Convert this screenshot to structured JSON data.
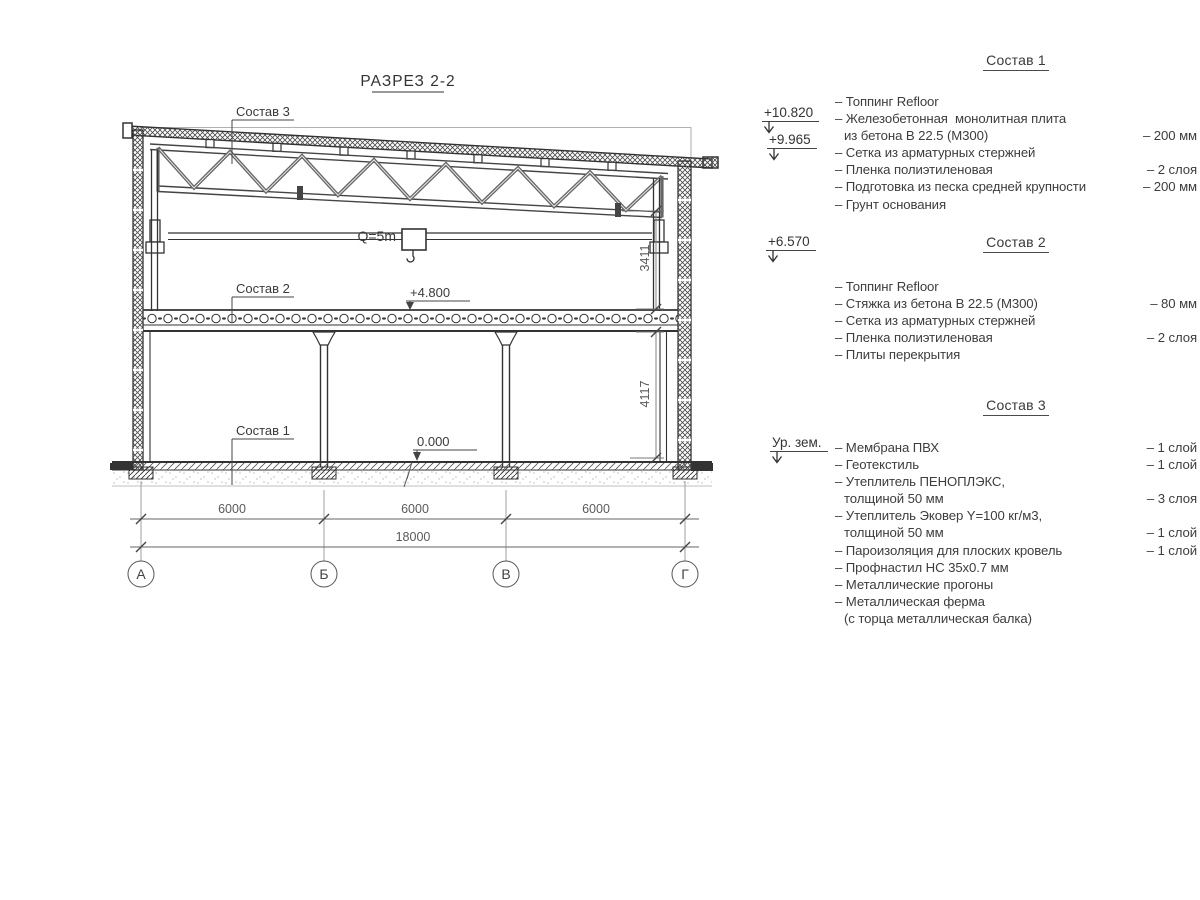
{
  "colors": {
    "background": "#ffffff",
    "line": "#3f3f3f",
    "dim_text": "#5a5a5a",
    "text": "#3a3a3a"
  },
  "drawing": {
    "title": "РАЗРЕЗ 2-2",
    "callouts": {
      "c3": "Состав 3",
      "c2": "Состав 2",
      "c1": "Состав 1"
    },
    "crane_label": "Q=5m",
    "elev_mid": "+4.800",
    "elev_zero": "0.000",
    "dims": {
      "span1": "6000",
      "span2": "6000",
      "span3": "6000",
      "total": "18000",
      "v_upper": "3411",
      "v_lower": "4117"
    },
    "axes": [
      "А",
      "Б",
      "В",
      "Г"
    ]
  },
  "elevation_marks": [
    {
      "label": "+10.820"
    },
    {
      "label": "+9.965"
    },
    {
      "label": "+6.570"
    },
    {
      "label": "Ур. зем."
    }
  ],
  "lists": [
    {
      "title": "Состав 1",
      "rows": [
        {
          "text": "– Топпинг Refloor",
          "value": "",
          "indent": false
        },
        {
          "text": "– Железобетонная  монолитная плита",
          "value": "",
          "indent": false
        },
        {
          "text": "из бетона В 22.5 (М300)",
          "value": "– 200 мм",
          "indent": true
        },
        {
          "text": "– Сетка из арматурных стержней",
          "value": "",
          "indent": false
        },
        {
          "text": "– Пленка полиэтиленовая",
          "value": "–  2 слоя",
          "indent": false
        },
        {
          "text": "– Подготовка из песка средней крупности",
          "value": "– 200 мм",
          "indent": false
        },
        {
          "text": "– Грунт основания",
          "value": "",
          "indent": false
        }
      ]
    },
    {
      "title": "Состав 2",
      "rows": [
        {
          "text": "– Топпинг Refloor",
          "value": "",
          "indent": false
        },
        {
          "text": "– Стяжка из бетона В 22.5 (М300)",
          "value": "– 80 мм",
          "indent": false
        },
        {
          "text": "– Сетка из арматурных стержней",
          "value": "",
          "indent": false
        },
        {
          "text": "– Пленка полиэтиленовая",
          "value": "–  2 слоя",
          "indent": false
        },
        {
          "text": "– Плиты перекрытия",
          "value": "",
          "indent": false
        }
      ]
    },
    {
      "title": "Состав 3",
      "rows": [
        {
          "text": "– Мембрана ПВХ",
          "value": "– 1 слой",
          "indent": false
        },
        {
          "text": "– Геотекстиль",
          "value": "– 1 слой",
          "indent": false
        },
        {
          "text": "– Утеплитель ПЕНОПЛЭКС,",
          "value": "",
          "indent": false
        },
        {
          "text": "толщиной 50 мм",
          "value": "– 3 слоя",
          "indent": true
        },
        {
          "text": "– Утеплитель Эковер Y=100 кг/м3,",
          "value": "",
          "indent": false
        },
        {
          "text": "толщиной 50 мм",
          "value": "– 1 слой",
          "indent": true
        },
        {
          "text": "– Пароизоляция для плоских кровель",
          "value": "– 1 слой",
          "indent": false
        },
        {
          "text": "– Профнастил НС 35х0.7 мм",
          "value": "",
          "indent": false
        },
        {
          "text": "– Металлические прогоны",
          "value": "",
          "indent": false
        },
        {
          "text": "– Металлическая ферма",
          "value": "",
          "indent": false
        },
        {
          "text": "(с торца металлическая балка)",
          "value": "",
          "indent": true
        }
      ]
    }
  ]
}
